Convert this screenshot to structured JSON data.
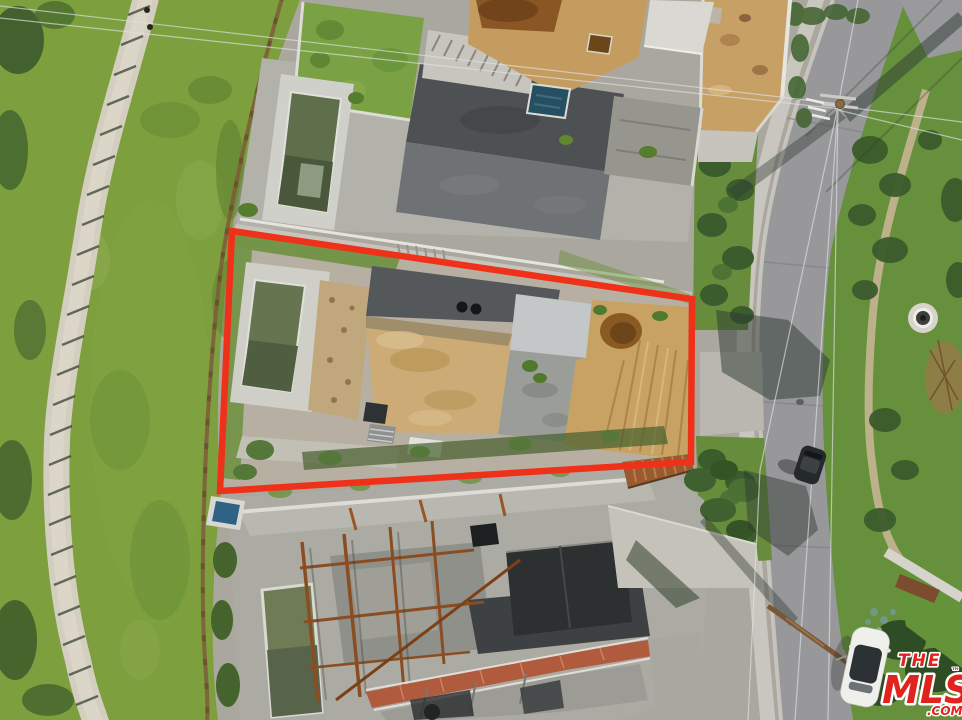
{
  "watermark": {
    "the": "THE",
    "mls": "MLS",
    "tm": "™",
    "com": ".COM",
    "color": "#e0231d",
    "outline_color": "#ffffff"
  },
  "annotation": {
    "outline_color": "#ee3118",
    "outline_points": "232,231 692,299 691,462 220,491",
    "outline_stroke_width": "6.5"
  },
  "palette": {
    "grass": "#7d9f3d",
    "grass_dark": "#44622b",
    "road_asphalt": "#98989a",
    "sidewalk": "#c8c6bf",
    "dirt_tan": "#c9a265",
    "mud_brown": "#8a5a22",
    "concrete_light": "#c6c4bc",
    "concrete_dark": "#54585a",
    "pool_water": "#667550",
    "rust_steel": "#8a4d22",
    "terracotta": "#b2583c"
  },
  "scene": {
    "description": "Aerial drone photo of a vacant hillside construction lot outlined in red between two other construction sites, with a grassy slope and dirt trail on the left and a curving street with utility poles, power lines and two cars on the right.",
    "elements": [
      "grass-hillside",
      "dirt-trail",
      "construction-site-top",
      "outlined-lot",
      "construction-site-bottom",
      "pools",
      "mud-puddle",
      "street",
      "sidewalk",
      "utility-poles",
      "power-lines",
      "white-car",
      "dark-car",
      "property-outline",
      "mls-watermark"
    ]
  }
}
